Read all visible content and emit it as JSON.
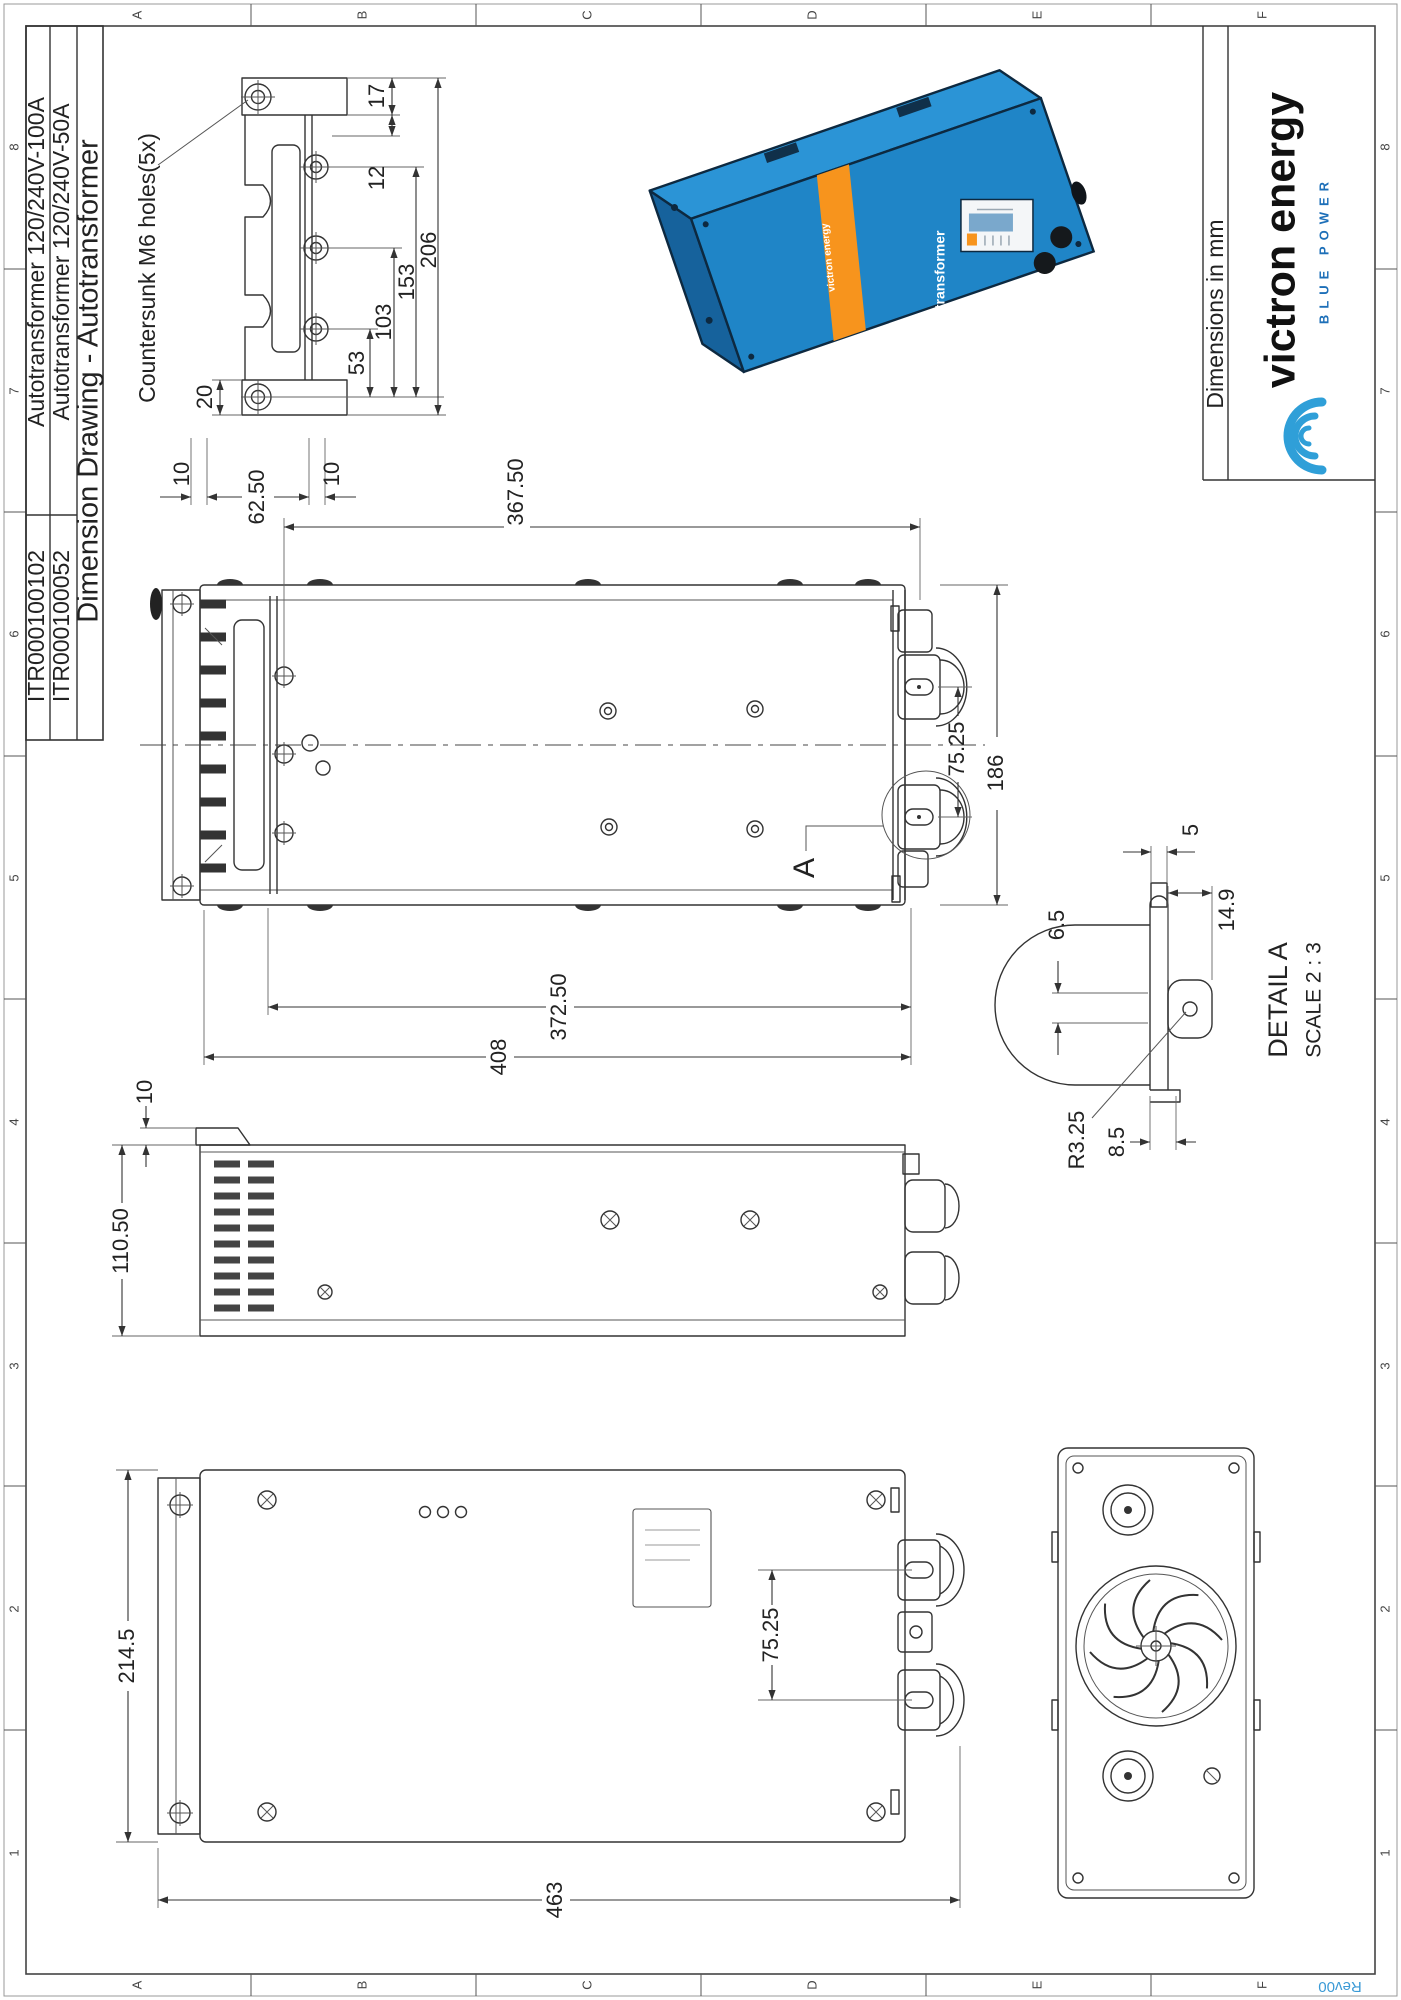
{
  "sheet": {
    "zone_letters": [
      "A",
      "B",
      "C",
      "D",
      "E",
      "F"
    ],
    "zone_numbers": [
      "8",
      "7",
      "6",
      "5",
      "4",
      "3",
      "2",
      "1"
    ],
    "revision": "Rev00"
  },
  "title_block": {
    "title": "Dimension Drawing - Autotransformer",
    "rows": [
      {
        "part_no": "ITR000100052",
        "description": "Autotransformer 120/240V-50A"
      },
      {
        "part_no": "ITR000100102",
        "description": "Autotransformer 120/240V-100A"
      }
    ]
  },
  "footer": {
    "note": "Dimensions in mm",
    "brand": "victron energy",
    "tagline": "BLUE POWER"
  },
  "views": {
    "bracket": {
      "note": "Countersunk M6 holes(5x)",
      "d17": "17",
      "d12": "12",
      "d206": "206",
      "d153": "153",
      "d103": "103",
      "d53": "53",
      "d20": "20",
      "d10a": "10",
      "d62": "62.50",
      "d10b": "10"
    },
    "top": {
      "d367": "367.50",
      "d186": "186",
      "d75": "75.25",
      "d372": "372.50",
      "d408": "408",
      "marker": "A"
    },
    "detail": {
      "title": "DETAIL A",
      "scale": "SCALE 2 : 3",
      "d65": "6.5",
      "d5": "5",
      "d149": "14.9",
      "dr": "R3.25",
      "d85": "8.5"
    },
    "side": {
      "d110": "110.50",
      "d10": "10"
    },
    "front": {
      "d214": "214.5",
      "d75": "75.25",
      "d463": "463"
    },
    "product": {
      "brand": "victron energy",
      "label": "Autotransformer"
    }
  },
  "colors": {
    "blue": "#1f85c7",
    "orange": "#f7941d",
    "logo_blue": "#2f9fd8"
  }
}
